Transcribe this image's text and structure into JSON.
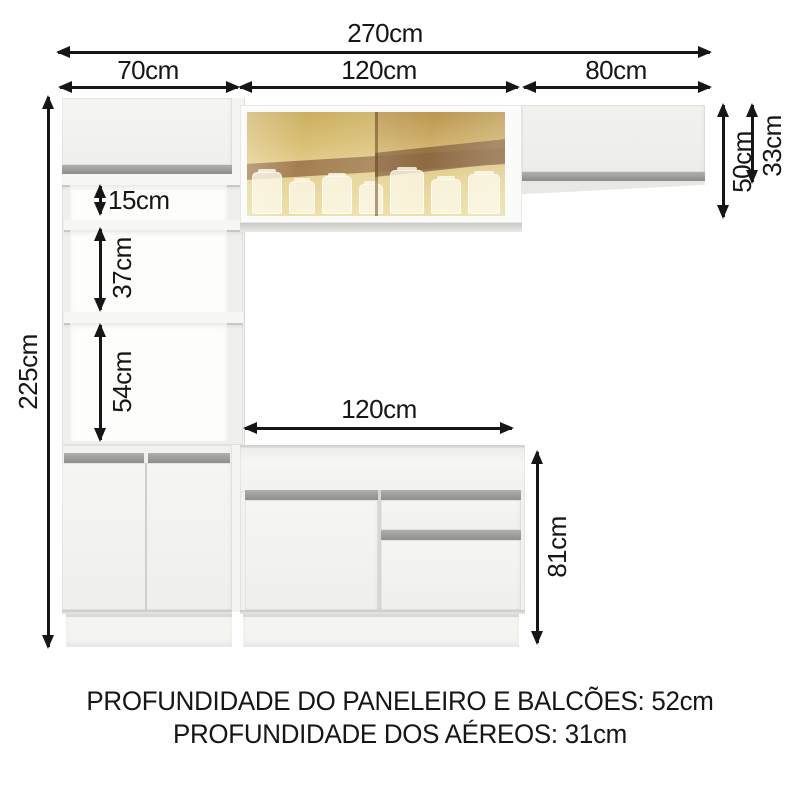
{
  "dimensions": {
    "total_width": "270cm",
    "tower_width": "70cm",
    "upper_glass_width": "120cm",
    "right_aerial_width": "80cm",
    "total_height": "225cm",
    "niche_small": "15cm",
    "niche_medium": "37cm",
    "niche_large": "54cm",
    "aerial_height": "50cm",
    "aerial_door_height": "33cm",
    "counter_width": "120cm",
    "counter_height": "81cm"
  },
  "footer": {
    "line1": "PROFUNDIDADE DO PANELEIRO E BALCÕES: 52cm",
    "line2": "PROFUNDIDADE DOS AÉREOS: 31cm"
  },
  "colors": {
    "background": "#ffffff",
    "cabinet_body": "#f1f1ee",
    "handle_strip": "#9a9a97",
    "glass_amber": "#d8bd72",
    "glass_band_brown": "#9b7348",
    "dimension_lines": "#161616"
  }
}
